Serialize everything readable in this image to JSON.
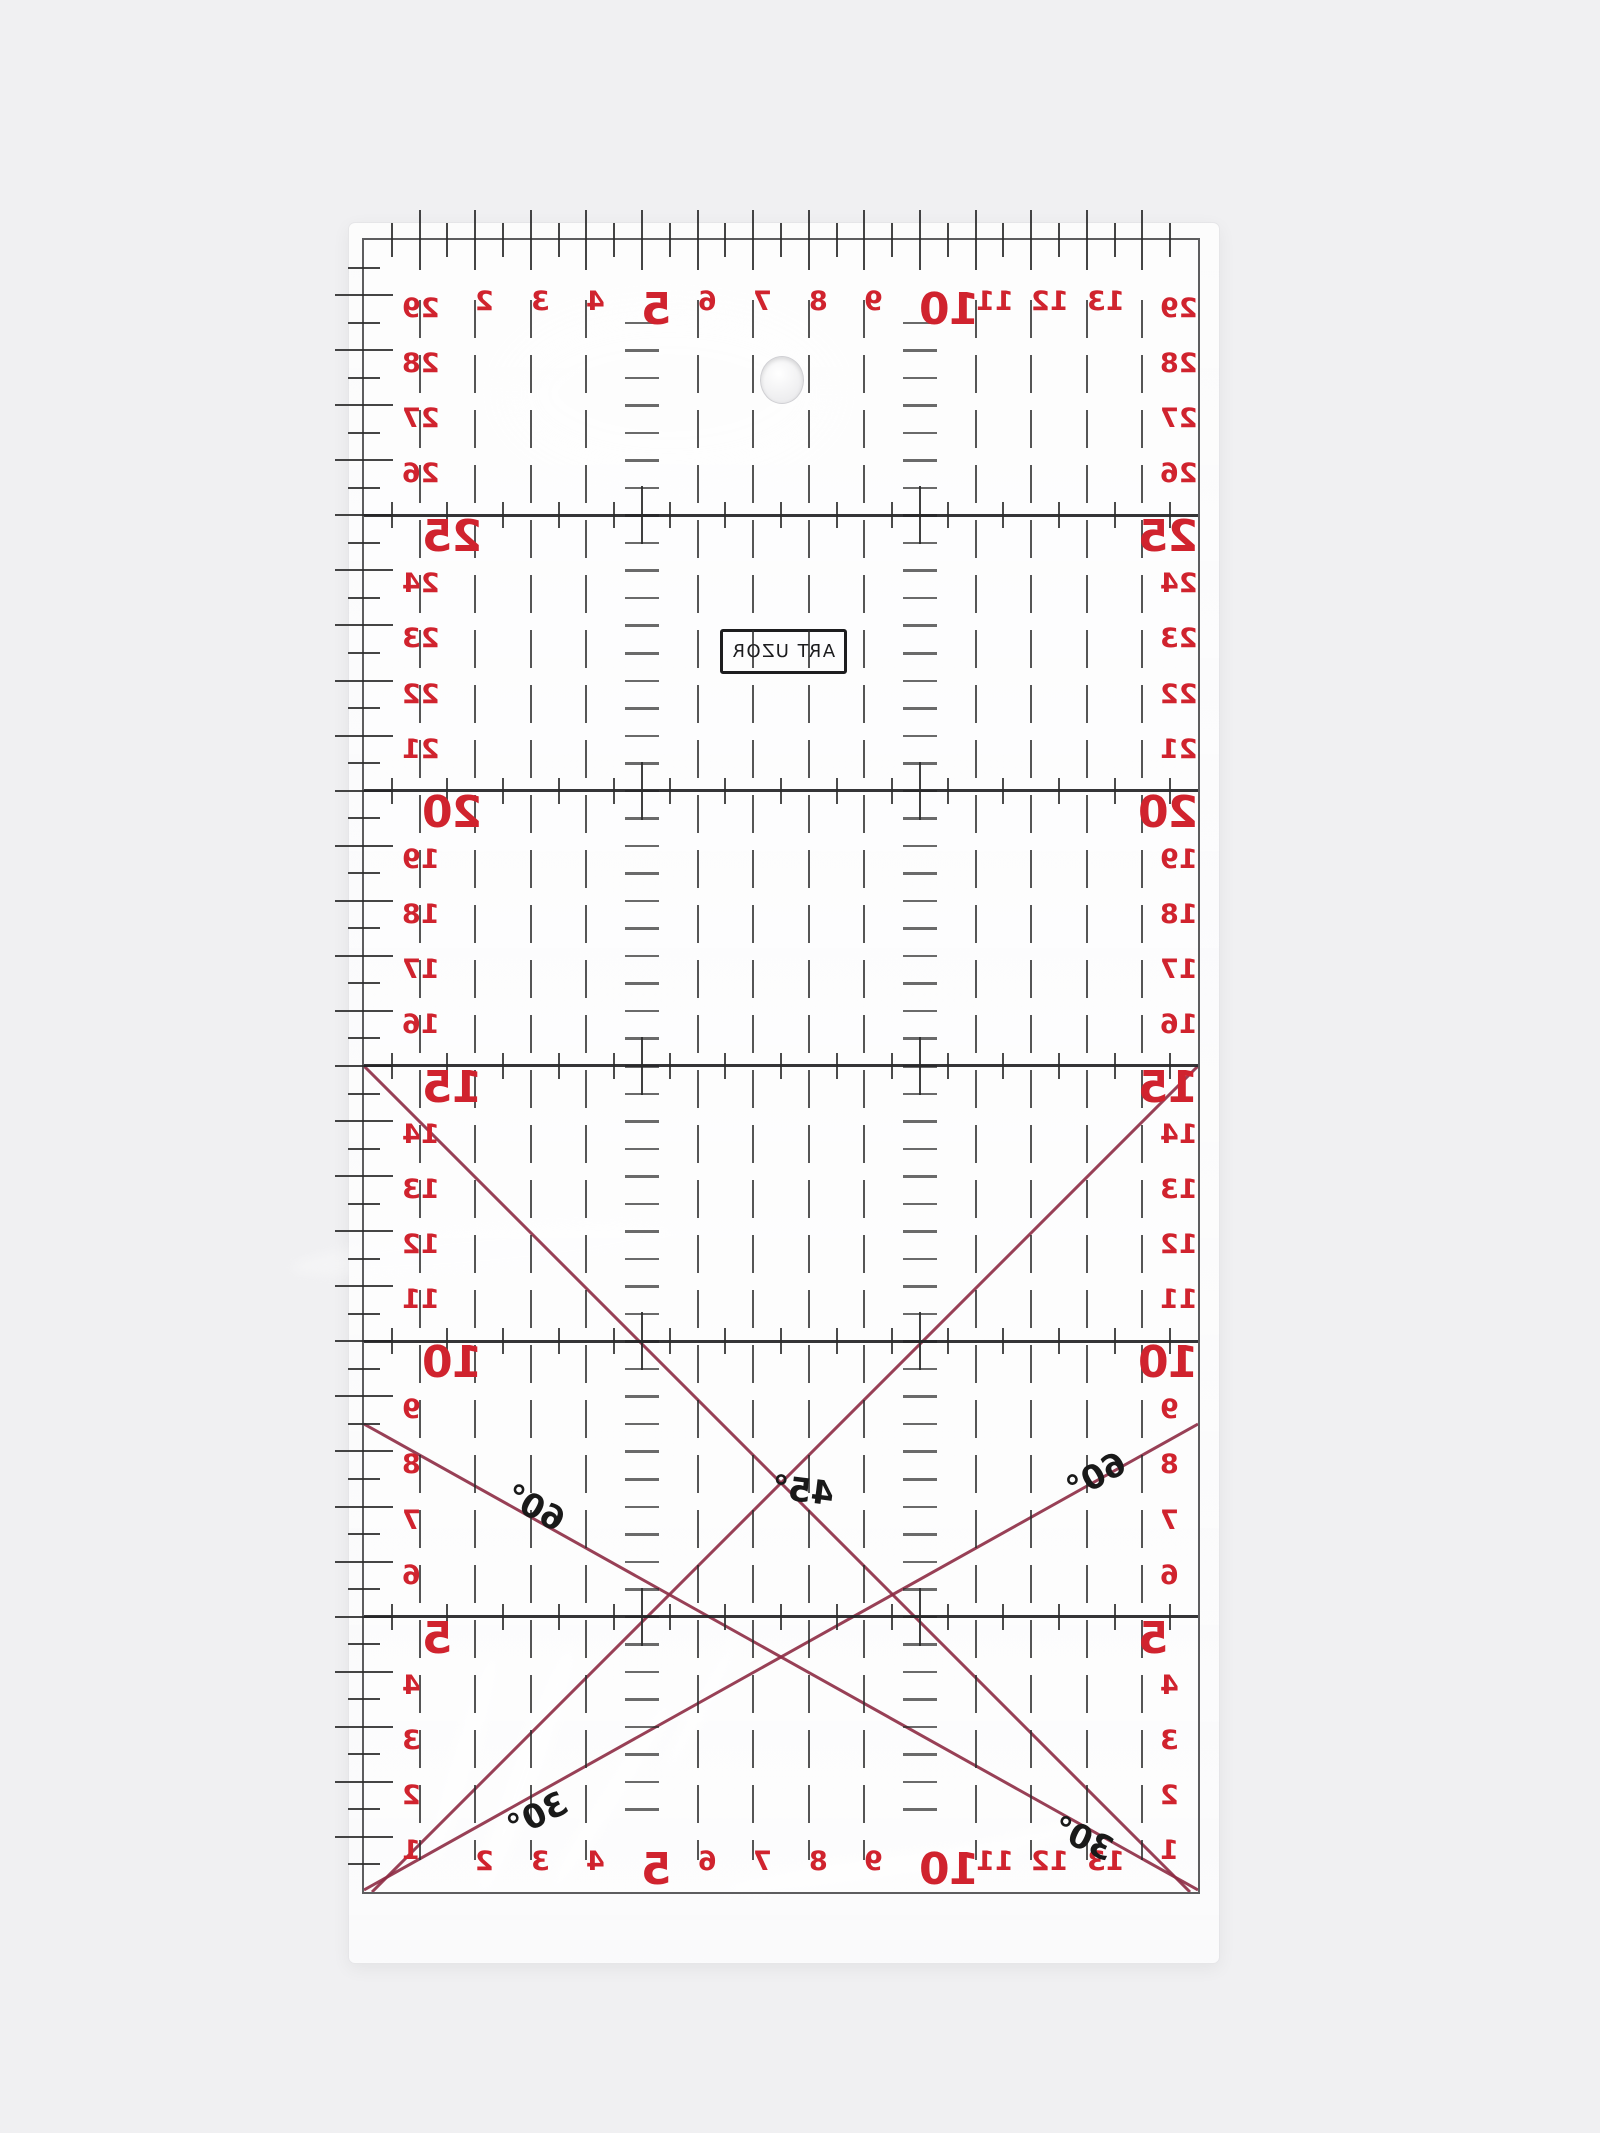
{
  "colors": {
    "background": "#f0f0f2",
    "number_red": "#d0232e",
    "angle_line_maroon": "#8e2c44",
    "print_black": "#2b2b2b"
  },
  "ruler": {
    "brand_text": "ART UZOR",
    "mirrored": true,
    "top_scale": [
      "2",
      "3",
      "4",
      "5",
      "6",
      "7",
      "8",
      "9",
      "10",
      "11",
      "12",
      "13"
    ],
    "bottom_scale": [
      "2",
      "3",
      "4",
      "5",
      "6",
      "7",
      "8",
      "9",
      "10",
      "11",
      "12",
      "13"
    ],
    "side_scale_left": [
      "29",
      "28",
      "27",
      "26",
      "25",
      "24",
      "23",
      "22",
      "21",
      "20",
      "19",
      "18",
      "17",
      "16",
      "15",
      "14",
      "13",
      "12",
      "11",
      "10",
      "9",
      "8",
      "7",
      "6",
      "5",
      "4",
      "3",
      "2",
      "1"
    ],
    "side_scale_right": [
      "29",
      "28",
      "27",
      "26",
      "25",
      "24",
      "23",
      "22",
      "21",
      "20",
      "19",
      "18",
      "17",
      "16",
      "15",
      "14",
      "13",
      "12",
      "11",
      "10",
      "9",
      "8",
      "7",
      "6",
      "5",
      "4",
      "3",
      "2",
      "1"
    ],
    "angle_labels": {
      "center": "45°",
      "upper_left": "60°",
      "upper_right": "60°",
      "lower_left": "30°",
      "lower_right": "30°"
    }
  }
}
